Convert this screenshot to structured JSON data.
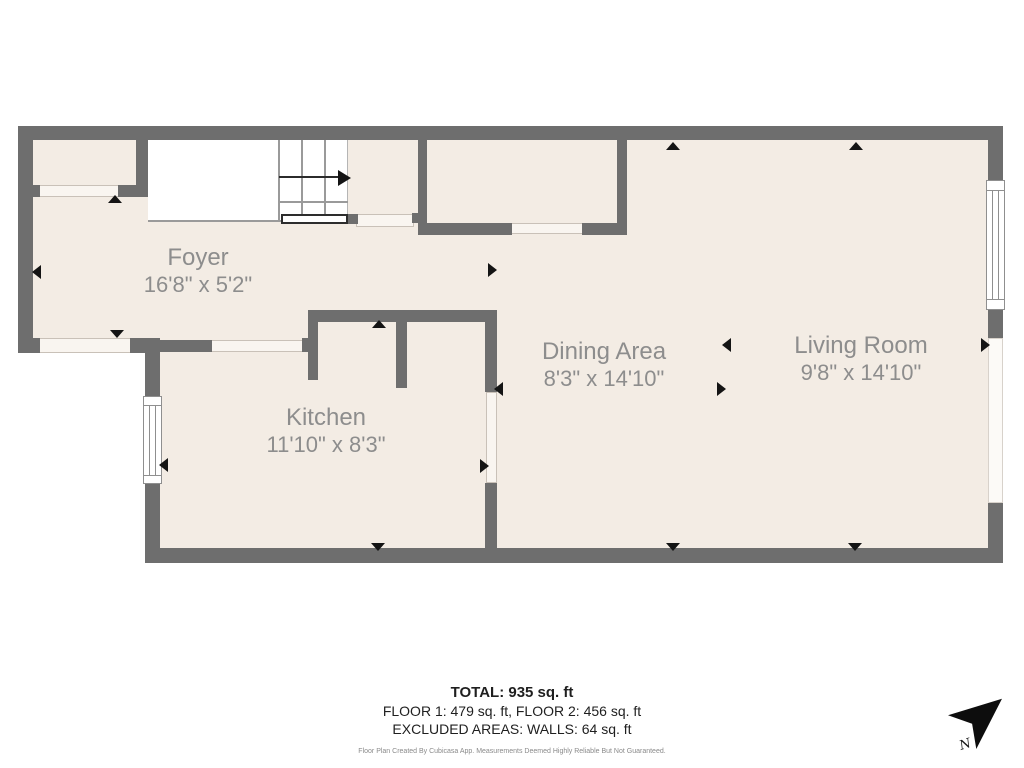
{
  "plan": {
    "colors": {
      "wall": "#6e6e6e",
      "floor": "#f3ece4",
      "label_text": "#8d8d8d",
      "marker": "#141414",
      "exterior": "#ffffff"
    },
    "rooms": [
      {
        "name": "Foyer",
        "dims": "16'8\" x 5'2\""
      },
      {
        "name": "Kitchen",
        "dims": "11'10\" x 8'3\""
      },
      {
        "name": "Dining Area",
        "dims": "8'3\" x 14'10\""
      },
      {
        "name": "Living Room",
        "dims": "9'8\" x 14'10\""
      }
    ],
    "summary": {
      "total": "TOTAL: 935 sq. ft",
      "floors": "FLOOR 1: 479 sq. ft, FLOOR 2: 456 sq. ft",
      "excluded": "EXCLUDED AREAS: WALLS: 64 sq. ft",
      "disclaimer": "Floor Plan Created By Cubicasa App. Measurements Deemed Highly Reliable But Not Guaranteed."
    },
    "compass": {
      "label": "N"
    }
  }
}
